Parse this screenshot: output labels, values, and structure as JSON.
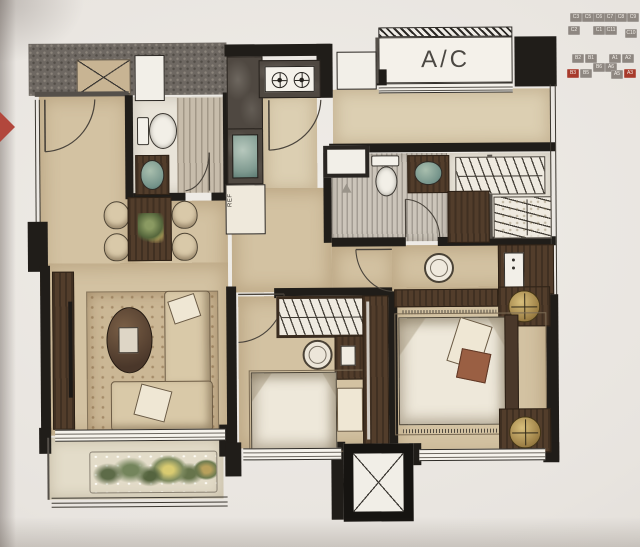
{
  "keyplan": {
    "units": [
      {
        "label": "C3"
      },
      {
        "label": "C5"
      },
      {
        "label": "C6"
      },
      {
        "label": "C7"
      },
      {
        "label": "C8"
      },
      {
        "label": "C9"
      },
      {
        "label": "C2"
      },
      {
        "label": "C1"
      },
      {
        "label": "C11"
      },
      {
        "label": "C10"
      },
      {
        "label": "B2"
      },
      {
        "label": "B1"
      },
      {
        "label": "A1"
      },
      {
        "label": "A2"
      },
      {
        "label": "B3"
      },
      {
        "label": "B5"
      },
      {
        "label": "B6"
      },
      {
        "label": "A6"
      },
      {
        "label": "A5"
      },
      {
        "label": "A3"
      }
    ],
    "highlighted_units": [
      "B3",
      "A3"
    ],
    "box_color": "#8e8781",
    "highlight_color": "#a73a2b"
  },
  "plan": {
    "ac_label": "A/C",
    "ref_label": "REF"
  },
  "colors": {
    "arrow": "#b2473c",
    "wall": "#201d19",
    "floor_tan": "#d3c2a2"
  }
}
